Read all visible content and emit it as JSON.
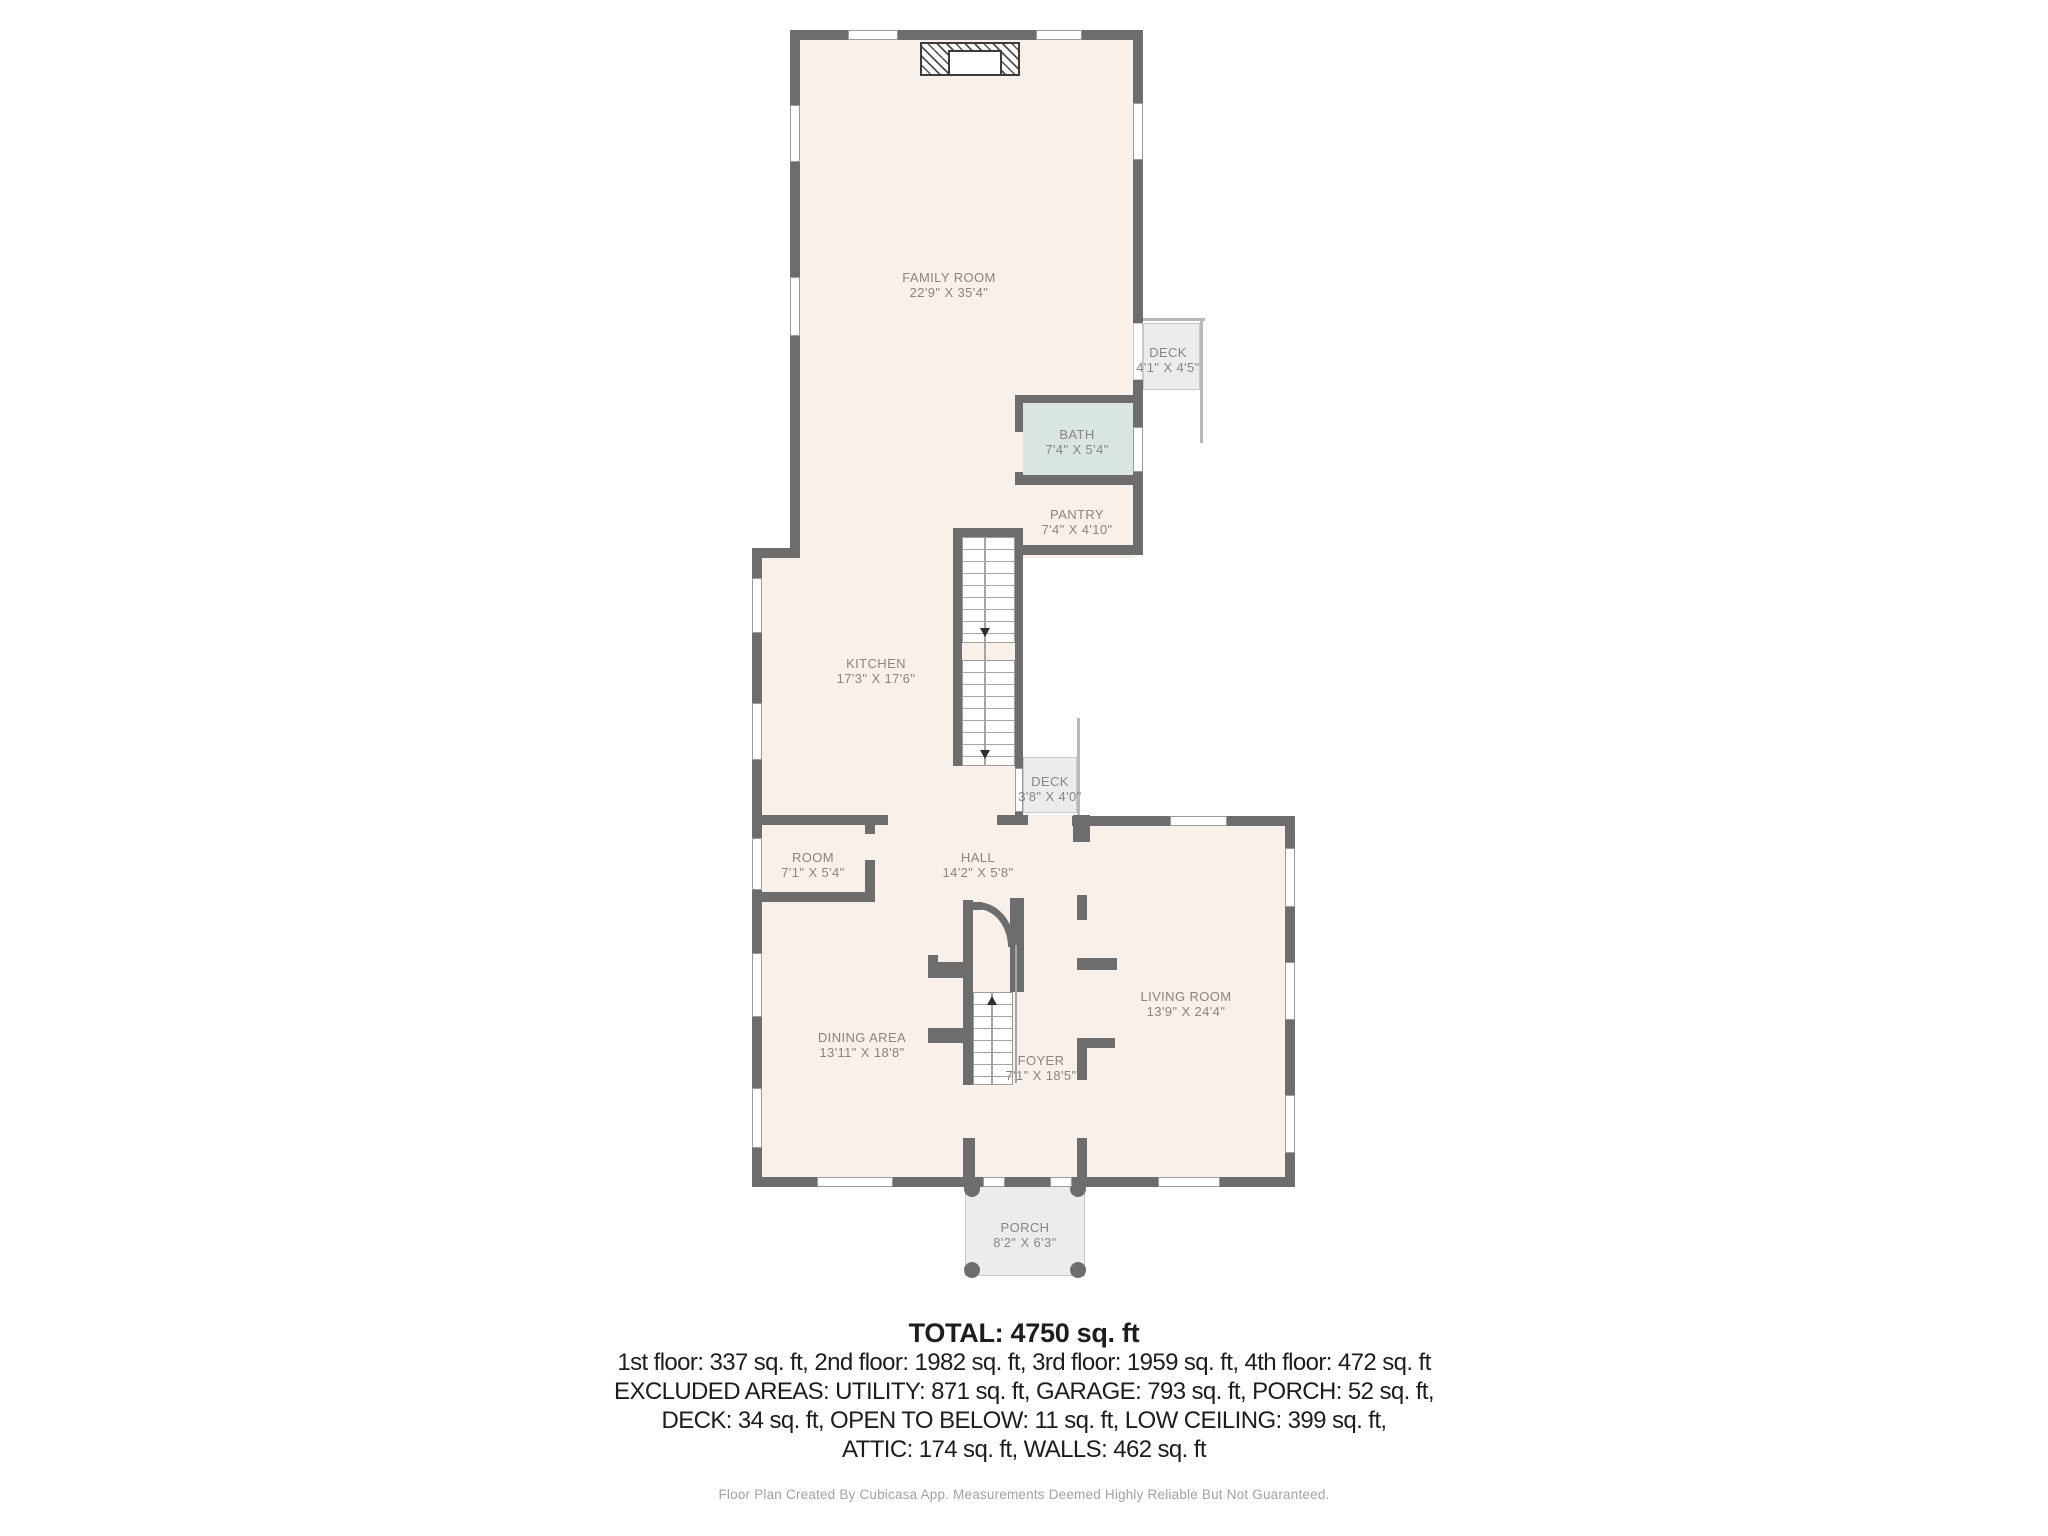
{
  "rooms": {
    "family_room": {
      "name": "FAMILY ROOM",
      "dims": "22'9\" X 35'4\""
    },
    "deck_upper": {
      "name": "DECK",
      "dims": "4'1\" X 4'5\""
    },
    "bath": {
      "name": "BATH",
      "dims": "7'4\" X 5'4\""
    },
    "pantry": {
      "name": "PANTRY",
      "dims": "7'4\" X 4'10\""
    },
    "kitchen": {
      "name": "KITCHEN",
      "dims": "17'3\" X 17'6\""
    },
    "deck_lower": {
      "name": "DECK",
      "dims": "3'8\" X 4'0\""
    },
    "room": {
      "name": "ROOM",
      "dims": "7'1\" X 5'4\""
    },
    "hall": {
      "name": "HALL",
      "dims": "14'2\" X 5'8\""
    },
    "dining_area": {
      "name": "DINING AREA",
      "dims": "13'11\" X 18'8\""
    },
    "foyer": {
      "name": "FOYER",
      "dims": "7'1\" X 18'5\""
    },
    "living_room": {
      "name": "LIVING ROOM",
      "dims": "13'9\" X 24'4\""
    },
    "porch": {
      "name": "PORCH",
      "dims": "8'2\" X 6'3\""
    }
  },
  "summary": {
    "total": "TOTAL: 4750 sq. ft",
    "lines": [
      "1st floor: 337 sq. ft, 2nd floor: 1982 sq. ft, 3rd floor: 1959 sq. ft, 4th floor: 472 sq. ft",
      "EXCLUDED AREAS: UTILITY: 871 sq. ft, GARAGE: 793 sq. ft, PORCH: 52 sq. ft,",
      "DECK: 34 sq. ft, OPEN TO BELOW: 11 sq. ft, LOW CEILING: 399 sq. ft,",
      "ATTIC: 174 sq. ft, WALLS: 462 sq. ft"
    ]
  },
  "footer": "Floor Plan Created By Cubicasa App. Measurements Deemed Highly Reliable But Not Guaranteed.",
  "colors": {
    "wall": "#6d6d6d",
    "floor": "#f8f0e9",
    "bath": "#d8e5e3",
    "deck": "#ececec",
    "label_text": "#8b857e",
    "summary_text": "#1d1d1d",
    "footer_text": "#a5a29e"
  }
}
